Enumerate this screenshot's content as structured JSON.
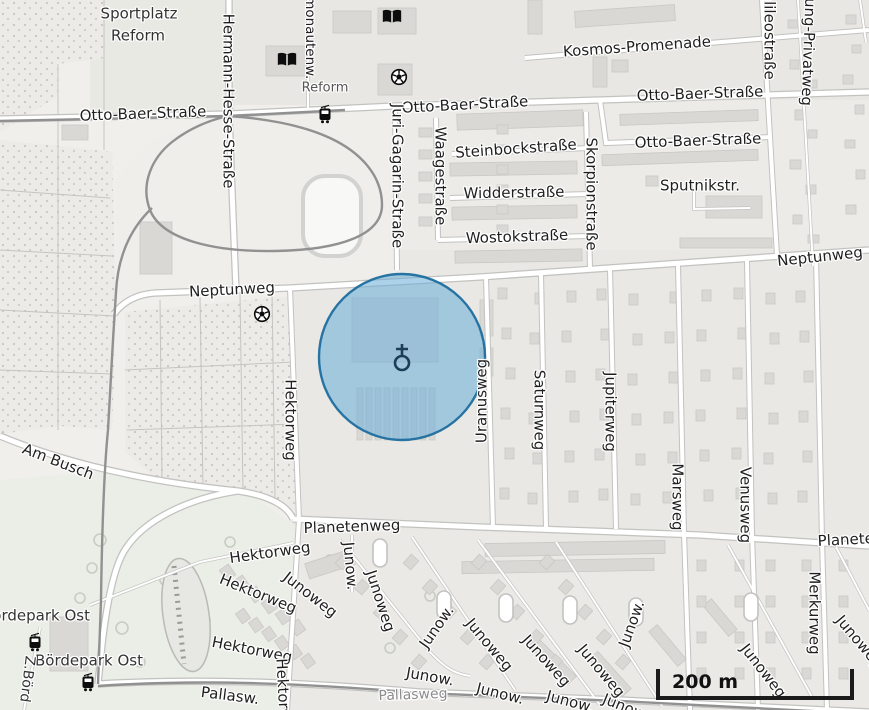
{
  "map": {
    "scale_bar": {
      "label": "200 m"
    },
    "highlight": {
      "cx": 402,
      "cy": 357,
      "r": 83,
      "fill": "#67add9",
      "fill_opacity": 0.55,
      "stroke": "#1e6e9f",
      "stroke_opacity": 0.95,
      "icon": "place-of-worship-icon",
      "icon_color": "#1c3e59"
    },
    "icons": [
      {
        "name": "library-icon",
        "x": 287,
        "y": 62
      },
      {
        "name": "library-icon",
        "x": 392,
        "y": 19
      },
      {
        "name": "soccer-icon",
        "x": 399,
        "y": 79
      },
      {
        "name": "soccer-icon",
        "x": 262,
        "y": 316
      },
      {
        "name": "tram-stop-icon",
        "x": 325,
        "y": 116
      },
      {
        "name": "tram-stop-icon",
        "x": 35,
        "y": 644
      },
      {
        "name": "tram-stop-icon",
        "x": 88,
        "y": 684
      }
    ],
    "labels": [
      {
        "name": "area-label",
        "text": "Sportplatz",
        "x": 139,
        "y": 14,
        "rot": 0,
        "color": "#333"
      },
      {
        "name": "area-label",
        "text": "Reform",
        "x": 138,
        "y": 36,
        "rot": 0,
        "color": "#333"
      },
      {
        "name": "street-label",
        "text": "Otto-Baer-Straße",
        "x": 143,
        "y": 114,
        "rot": -2
      },
      {
        "name": "street-label",
        "text": "Hermann-Hesse-Straße",
        "x": 228,
        "y": 101,
        "rot": 90
      },
      {
        "name": "street-label",
        "text": "Kosmonautenw.",
        "x": 309,
        "y": 26,
        "rot": 90,
        "size": 13.5
      },
      {
        "name": "stop-label",
        "text": "Reform",
        "x": 325,
        "y": 88,
        "rot": 0,
        "size": 13,
        "color": "#555"
      },
      {
        "name": "street-label",
        "text": "Otto-Baer-Straße",
        "x": 465,
        "y": 105,
        "rot": -3
      },
      {
        "name": "street-label",
        "text": "Kosmos-Promenade",
        "x": 637,
        "y": 47,
        "rot": -4
      },
      {
        "name": "street-label",
        "text": "Otto-Baer-Straße",
        "x": 700,
        "y": 94,
        "rot": -2
      },
      {
        "name": "street-label",
        "text": "Otto-Baer-Straße",
        "x": 698,
        "y": 141,
        "rot": -2
      },
      {
        "name": "street-label",
        "text": "Galileostraße",
        "x": 769,
        "y": 30,
        "rot": 90
      },
      {
        "name": "street-label",
        "text": "ung-Privatweg",
        "x": 808,
        "y": 52,
        "rot": 92
      },
      {
        "name": "street-label",
        "text": "Juri-Gagarin-Straße",
        "x": 397,
        "y": 176,
        "rot": 90
      },
      {
        "name": "street-label",
        "text": "Waagestraße",
        "x": 440,
        "y": 176,
        "rot": 90
      },
      {
        "name": "street-label",
        "text": "Steinbockstraße",
        "x": 516,
        "y": 149,
        "rot": -4
      },
      {
        "name": "street-label",
        "text": "Widderstraße",
        "x": 514,
        "y": 193,
        "rot": -1
      },
      {
        "name": "street-label",
        "text": "Wostokstraße",
        "x": 517,
        "y": 237,
        "rot": -2
      },
      {
        "name": "street-label",
        "text": "Skorpionstraße",
        "x": 591,
        "y": 194,
        "rot": 90
      },
      {
        "name": "street-label",
        "text": "Sputnikstr.",
        "x": 700,
        "y": 186,
        "rot": 0
      },
      {
        "name": "street-label",
        "text": "Neptunweg",
        "x": 232,
        "y": 290,
        "rot": -3
      },
      {
        "name": "street-label",
        "text": "Neptunweg",
        "x": 820,
        "y": 257,
        "rot": -6
      },
      {
        "name": "street-label",
        "text": "Hektorweg",
        "x": 290,
        "y": 420,
        "rot": 90
      },
      {
        "name": "street-label",
        "text": "Uranusweg",
        "x": 482,
        "y": 401,
        "rot": -90
      },
      {
        "name": "street-label",
        "text": "Saturnweg",
        "x": 539,
        "y": 410,
        "rot": 90
      },
      {
        "name": "street-label",
        "text": "Jupiterweg",
        "x": 610,
        "y": 412,
        "rot": 90
      },
      {
        "name": "street-label",
        "text": "Marsweg",
        "x": 677,
        "y": 497,
        "rot": 90
      },
      {
        "name": "street-label",
        "text": "Venusweg",
        "x": 745,
        "y": 505,
        "rot": 90
      },
      {
        "name": "street-label",
        "text": "Merkurweg",
        "x": 814,
        "y": 613,
        "rot": 90
      },
      {
        "name": "street-label",
        "text": "Am Busch",
        "x": 58,
        "y": 462,
        "rot": 21
      },
      {
        "name": "street-label",
        "text": "Planetenweg",
        "x": 352,
        "y": 527,
        "rot": -2
      },
      {
        "name": "street-label",
        "text": "Planetenweg",
        "x": 866,
        "y": 539,
        "rot": -3
      },
      {
        "name": "street-label",
        "text": "Hektorweg",
        "x": 270,
        "y": 553,
        "rot": -8
      },
      {
        "name": "street-label",
        "text": "Junoweg",
        "x": 310,
        "y": 595,
        "rot": 38
      },
      {
        "name": "street-label",
        "text": "Junow.",
        "x": 350,
        "y": 566,
        "rot": 85
      },
      {
        "name": "street-label",
        "text": "Junoweg",
        "x": 380,
        "y": 601,
        "rot": 72
      },
      {
        "name": "street-label",
        "text": "Hektorweg",
        "x": 258,
        "y": 594,
        "rot": 22
      },
      {
        "name": "street-label",
        "text": "Hektorweg",
        "x": 252,
        "y": 650,
        "rot": 11
      },
      {
        "name": "street-label",
        "text": "Hektorweg",
        "x": 283,
        "y": 699,
        "rot": 87
      },
      {
        "name": "street-label",
        "text": "Pallasw.",
        "x": 230,
        "y": 696,
        "rot": 7
      },
      {
        "name": "street-label",
        "text": "Pallasweg",
        "x": 413,
        "y": 695,
        "rot": -2,
        "size": 14,
        "color": "#8c8c8c"
      },
      {
        "name": "street-label",
        "text": "Junow.",
        "x": 437,
        "y": 627,
        "rot": -55
      },
      {
        "name": "street-label",
        "text": "Junow.",
        "x": 430,
        "y": 677,
        "rot": 10
      },
      {
        "name": "street-label",
        "text": "Junoweg",
        "x": 489,
        "y": 645,
        "rot": 50
      },
      {
        "name": "street-label",
        "text": "Junow.",
        "x": 500,
        "y": 694,
        "rot": 14
      },
      {
        "name": "street-label",
        "text": "Junoweg",
        "x": 546,
        "y": 661,
        "rot": 48
      },
      {
        "name": "street-label",
        "text": "Junoweg",
        "x": 601,
        "y": 671,
        "rot": 50
      },
      {
        "name": "street-label",
        "text": "Junow.",
        "x": 632,
        "y": 624,
        "rot": -70
      },
      {
        "name": "street-label",
        "text": "Junow.",
        "x": 570,
        "y": 702,
        "rot": 15
      },
      {
        "name": "street-label",
        "text": "Junow",
        "x": 624,
        "y": 707,
        "rot": 22
      },
      {
        "name": "street-label",
        "text": "Junoweg",
        "x": 763,
        "y": 671,
        "rot": 52
      },
      {
        "name": "street-label",
        "text": "Junoweg",
        "x": 859,
        "y": 642,
        "rot": 50
      },
      {
        "name": "area-label",
        "text": "Bördepark Ost",
        "x": 36,
        "y": 616,
        "rot": 0,
        "color": "#333"
      },
      {
        "name": "area-label",
        "text": "Bördepark Ost",
        "x": 89,
        "y": 661,
        "rot": 0,
        "color": "#333"
      },
      {
        "name": "street-label",
        "text": "Z.Börd",
        "x": 27,
        "y": 679,
        "rot": 97,
        "size": 14,
        "color": "#333"
      }
    ]
  }
}
